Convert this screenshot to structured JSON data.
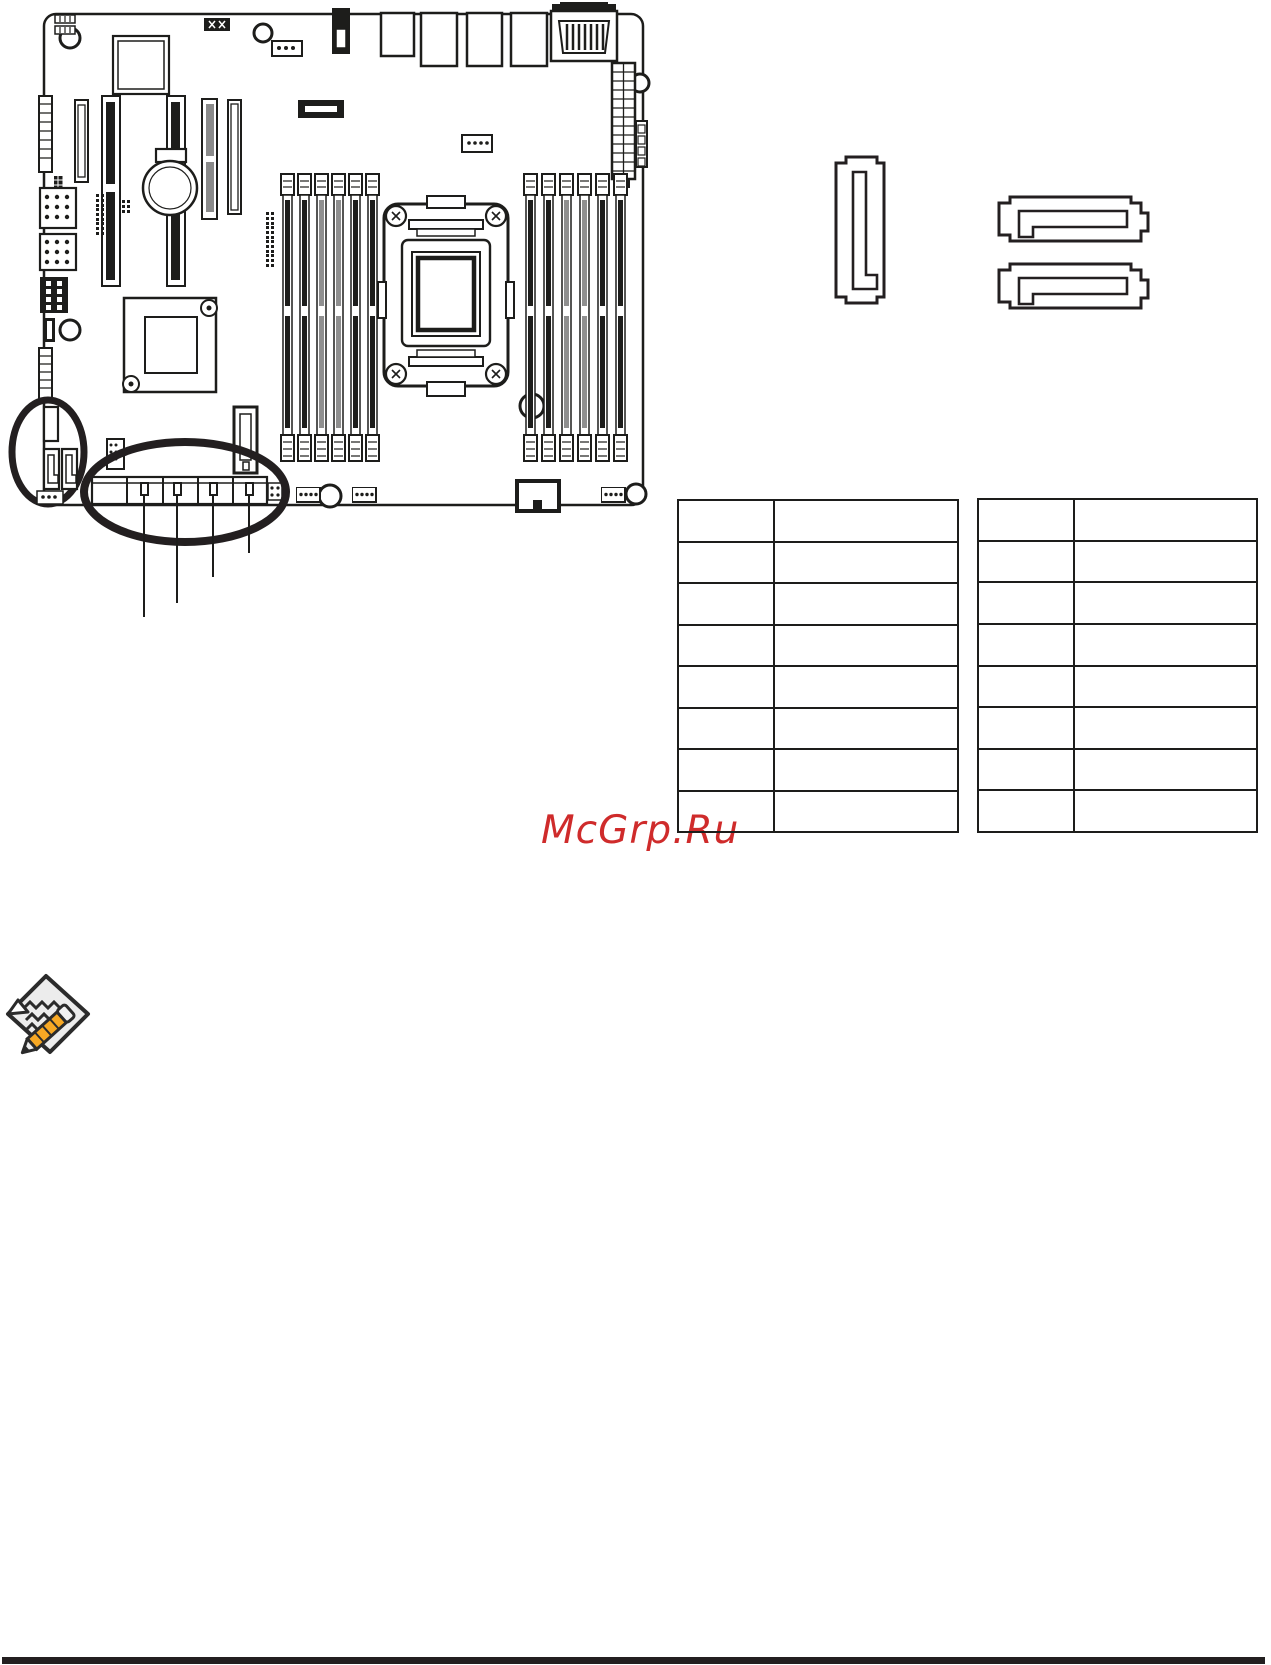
{
  "watermark": {
    "text": "McGrp.Ru",
    "color": "#cf2b2b"
  },
  "connector_tables": {
    "left": {
      "rows": [
        [
          "",
          ""
        ],
        [
          "",
          ""
        ],
        [
          "",
          ""
        ],
        [
          "",
          ""
        ],
        [
          "",
          ""
        ],
        [
          "",
          ""
        ],
        [
          "",
          ""
        ],
        [
          "",
          ""
        ]
      ]
    },
    "right": {
      "rows": [
        [
          "",
          ""
        ],
        [
          "",
          ""
        ],
        [
          "",
          ""
        ],
        [
          "",
          ""
        ],
        [
          "",
          ""
        ],
        [
          "",
          ""
        ],
        [
          "",
          ""
        ],
        [
          "",
          ""
        ]
      ]
    }
  },
  "diagram": {
    "type": "motherboard-layout-top-view",
    "callouts": {
      "small_circle": "onboard vertical SATA pair",
      "large_ellipse": "horizontal SATA port row",
      "leader_lines": 4
    },
    "line_color": "#1d1d1b"
  },
  "connector_symbols": {
    "vertical_sata_outline": 1,
    "horizontal_sata_outline": 2
  },
  "icons": {
    "note": "note-pencil-icon"
  },
  "colors": {
    "line": "#1d1d1b",
    "accent_red": "#cf2b2b",
    "footer_bar": "#231f20",
    "pencil_orange": "#f7a824",
    "paper_gray": "#ececec"
  }
}
